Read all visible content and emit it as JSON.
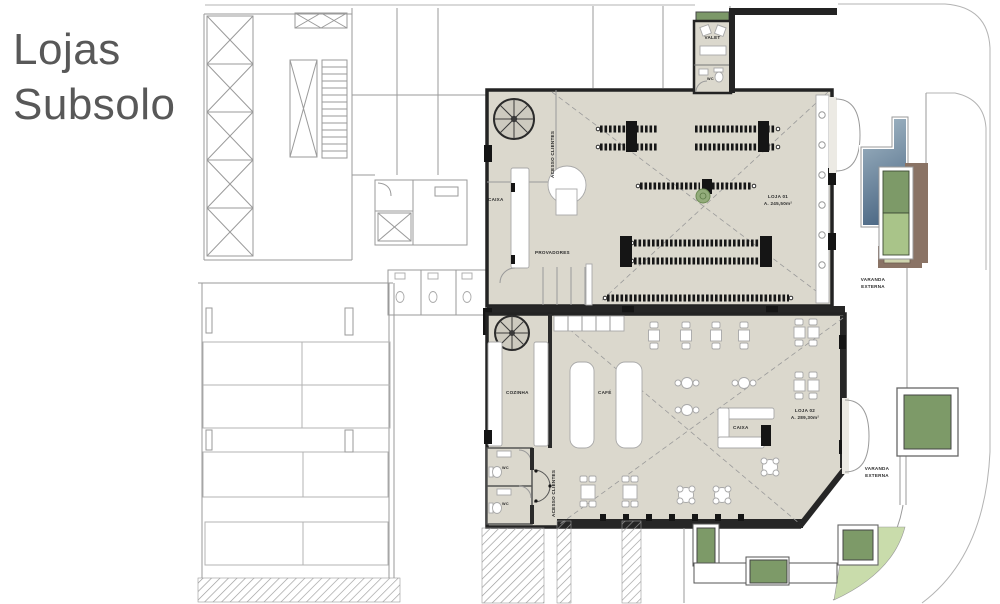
{
  "title": {
    "line1": "Lojas",
    "line2": "Subsolo"
  },
  "valet": {
    "label": "VALET",
    "wc": "WC"
  },
  "stores": {
    "loja1": {
      "name": "LOJA 01",
      "area": "A. 245,50m²",
      "labels": {
        "caixa": "CAIXA",
        "provadores": "PROVADORES",
        "acesso": "ACESSO CLIENTES"
      }
    },
    "loja2": {
      "name": "LOJA 02",
      "area": "A. 289,30m²",
      "labels": {
        "cozinha": "COZINHA",
        "cafe": "CAFÉ",
        "caixa": "CAIXA",
        "acesso": "ACESSO CLIENTES",
        "wc1": "WC",
        "wc2": "WC"
      }
    }
  },
  "varanda": {
    "upper": {
      "line1": "VARANDA",
      "line2": "EXTERNA"
    },
    "lower": {
      "line1": "VARANDA",
      "line2": "EXTERNA"
    }
  },
  "colors": {
    "floor_beige": "#dbd8cd",
    "wall_dark": "#232323",
    "line_gray": "#9a9a9a",
    "green_dark": "#7d9a68",
    "green_light": "#a9c489",
    "green_pale": "#c9dcab",
    "brown": "#8a7365",
    "pool_top": "#a8bcc9",
    "pool_bottom": "#4f6b87",
    "title_gray": "#585858"
  }
}
